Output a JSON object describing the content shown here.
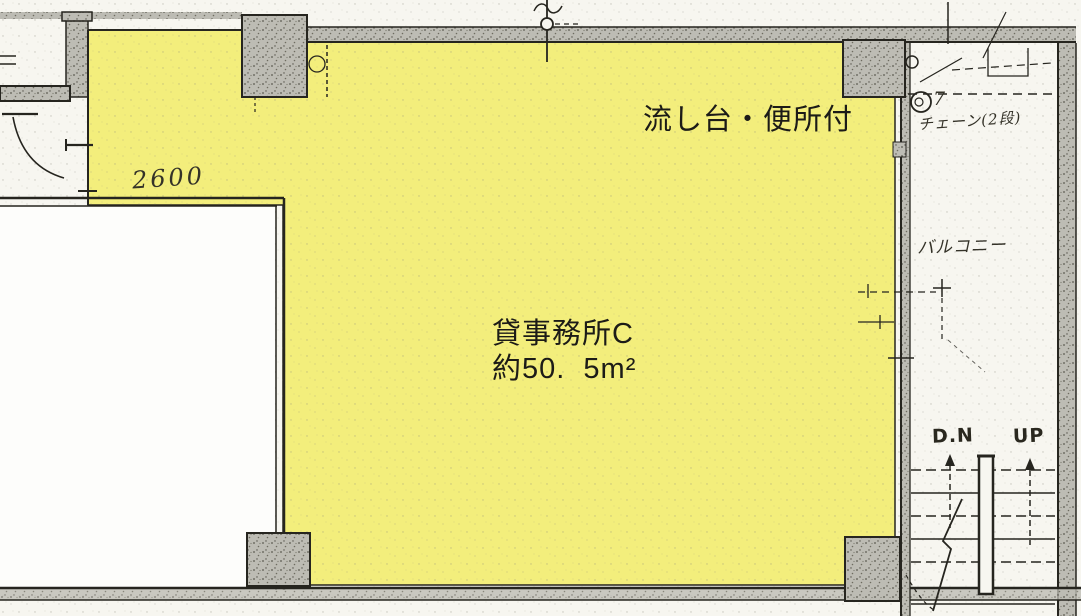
{
  "floorplan": {
    "unit": {
      "name": "貸事務所C",
      "area": "約50.  5m²",
      "features": "流し台・便所付"
    },
    "annotations": {
      "dimension": "2600",
      "balcony": "バルコニー",
      "chain_note": "チェーン(2段)",
      "stair_down": "D.N",
      "stair_up": "UP",
      "circle_number": "7"
    },
    "colors": {
      "highlight": "#f3ee7c",
      "wall": "#bdbcb4",
      "line": "#26251f",
      "paper": "#f7f6f0"
    }
  }
}
